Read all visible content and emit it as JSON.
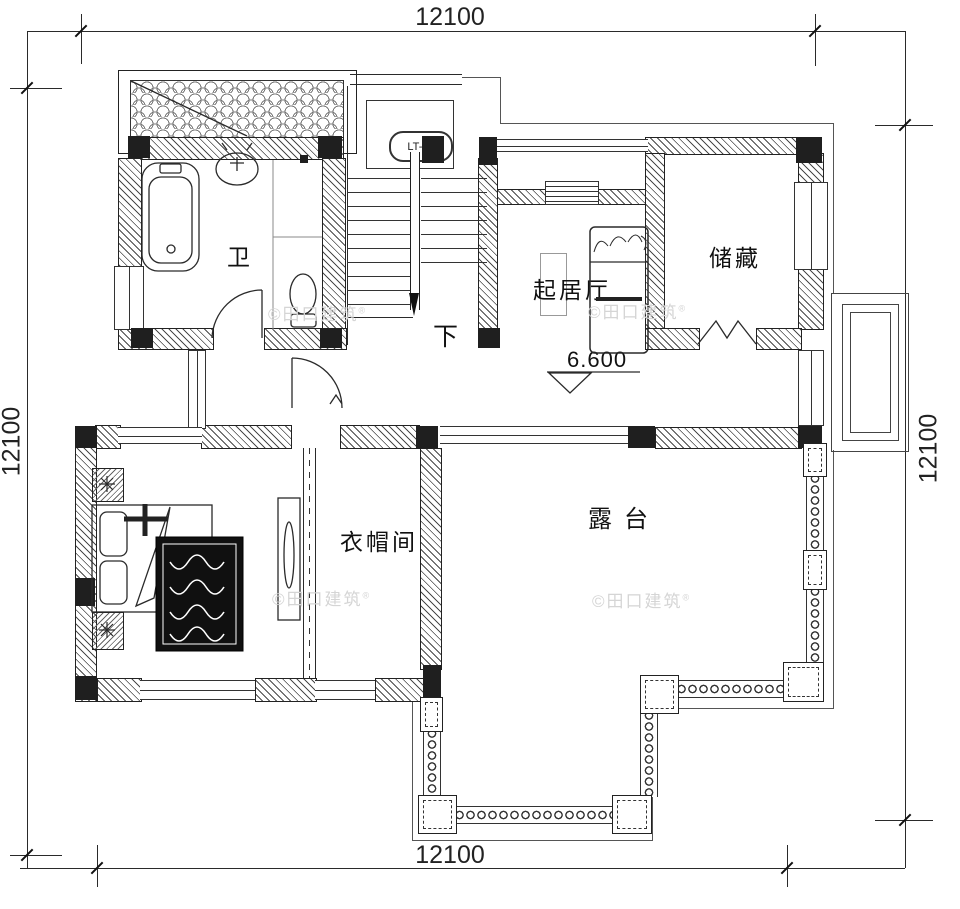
{
  "dimensions": {
    "top": "12100",
    "bottom": "12100",
    "left": "12100",
    "right": "12100"
  },
  "rooms": {
    "bathroom": "卫",
    "storage": "储藏",
    "living_room": "起居厅",
    "bedroom": "卧室",
    "cloakroom": "衣帽间",
    "terrace": "露台"
  },
  "stairs": {
    "label": "LT-01",
    "direction_text": "下"
  },
  "elevation_marker": {
    "value": "6.600"
  },
  "watermark": {
    "text": "©田口建筑",
    "registered_mark": "®"
  },
  "colors": {
    "line": "#2a2a2a",
    "column_fill": "#1f1f1f",
    "watermark": "#d5d5d5",
    "background": "#ffffff"
  }
}
